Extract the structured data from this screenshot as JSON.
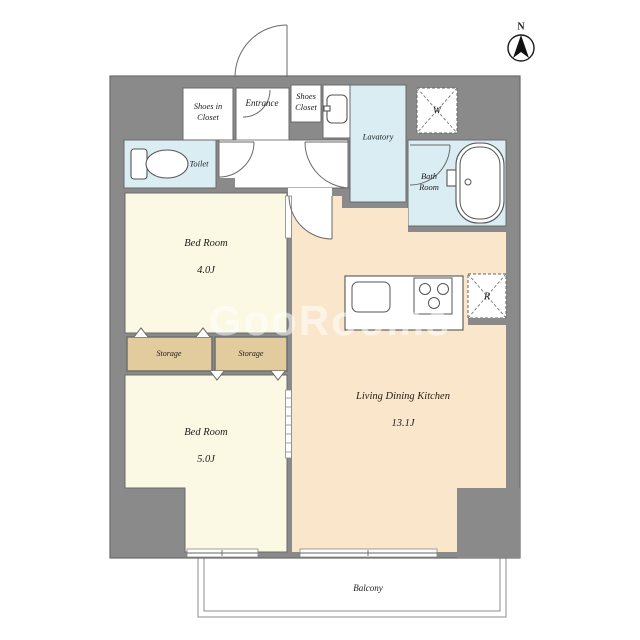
{
  "compass": {
    "label": "N"
  },
  "watermark": {
    "text": "GooRooms"
  },
  "rooms": {
    "shoes_in_closet": {
      "label": "Shoes in\nCloset"
    },
    "entrance": {
      "label": "Entrance"
    },
    "shoes_closet": {
      "label": "Shoes\nCloset"
    },
    "lavatory": {
      "label": "Lavatory"
    },
    "toilet": {
      "label": "Toilet"
    },
    "bath_room": {
      "label": "Bath\nRoom"
    },
    "washer_space": {
      "label": "W"
    },
    "refrigerator_space": {
      "label": "R"
    },
    "bed_room_1": {
      "label": "Bed Room",
      "size": "4.0J"
    },
    "bed_room_2": {
      "label": "Bed Room",
      "size": "5.0J"
    },
    "living_dining_kitchen": {
      "label": "Living Dining Kitchen",
      "size": "13.1J"
    },
    "storage_left": {
      "label": "Storage"
    },
    "storage_right": {
      "label": "Storage"
    },
    "balcony": {
      "label": "Balcony"
    }
  },
  "icons": {
    "compass": "north-arrow-icon",
    "toilet": "toilet-icon",
    "washbasin": "washbasin-icon",
    "bathtub": "bathtub-icon",
    "kitchen_sink": "kitchen-sink-icon",
    "stove": "stove-burners-icon",
    "washer_space": "washing-machine-space-icon",
    "refrigerator_space": "refrigerator-space-icon"
  },
  "colors": {
    "wall": "#8a8a8a",
    "wall_edge": "#6b6b6b",
    "water_room": "#d9edf3",
    "bedroom": "#fbf9e4",
    "ldk": "#fae7cb",
    "storage": "#e2cb9c",
    "line": "#555555"
  }
}
